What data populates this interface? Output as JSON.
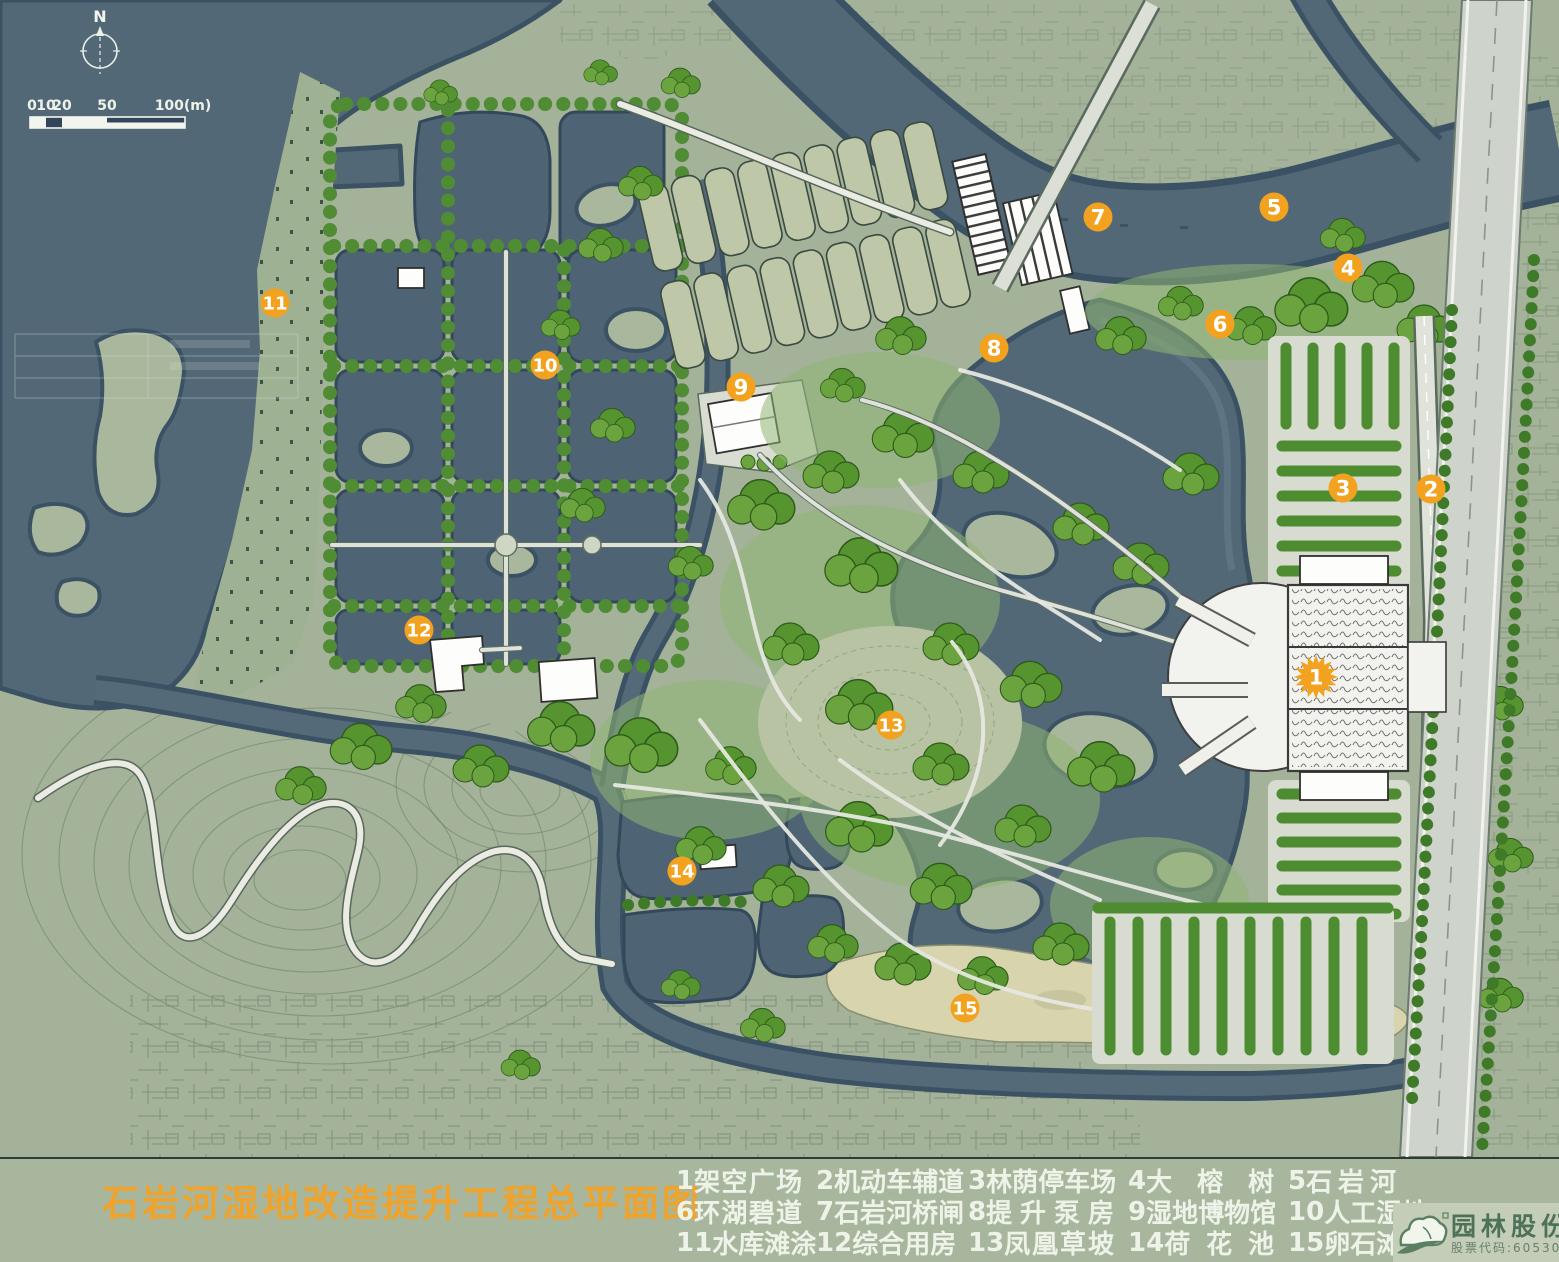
{
  "map": {
    "title": "石岩河湿地改造提升工程总平面图",
    "north_label": "N",
    "scale_bar": {
      "labels": [
        "0",
        "10",
        "20",
        "50",
        "100(m)"
      ],
      "unit": "m"
    },
    "legend_rows": [
      [
        {
          "num": "1",
          "name": "架空广场"
        },
        {
          "num": "2",
          "name": "机动车辅道"
        },
        {
          "num": "3",
          "name": "林荫停车场"
        },
        {
          "num": "4",
          "name": "大榕树"
        },
        {
          "num": "5",
          "name": "石岩河"
        }
      ],
      [
        {
          "num": "6",
          "name": "环湖碧道"
        },
        {
          "num": "7",
          "name": "石岩河桥闸"
        },
        {
          "num": "8",
          "name": "提升泵房"
        },
        {
          "num": "9",
          "name": "湿地博物馆"
        },
        {
          "num": "10",
          "name": "人工湿地"
        }
      ],
      [
        {
          "num": "11",
          "name": "水库滩涂"
        },
        {
          "num": "12",
          "name": "综合用房"
        },
        {
          "num": "13",
          "name": "凤凰草坡"
        },
        {
          "num": "14",
          "name": "荷花池"
        },
        {
          "num": "15",
          "name": "卵石滩"
        }
      ]
    ],
    "markers": [
      {
        "num": "1",
        "x": 1316,
        "y": 677,
        "starburst": true
      },
      {
        "num": "2",
        "x": 1431,
        "y": 489
      },
      {
        "num": "3",
        "x": 1343,
        "y": 488
      },
      {
        "num": "4",
        "x": 1348,
        "y": 268
      },
      {
        "num": "5",
        "x": 1274,
        "y": 207
      },
      {
        "num": "6",
        "x": 1220,
        "y": 324
      },
      {
        "num": "7",
        "x": 1098,
        "y": 217
      },
      {
        "num": "8",
        "x": 994,
        "y": 348
      },
      {
        "num": "9",
        "x": 741,
        "y": 387
      },
      {
        "num": "10",
        "x": 545,
        "y": 365
      },
      {
        "num": "11",
        "x": 275,
        "y": 303
      },
      {
        "num": "12",
        "x": 419,
        "y": 630
      },
      {
        "num": "13",
        "x": 891,
        "y": 725
      },
      {
        "num": "14",
        "x": 682,
        "y": 871
      },
      {
        "num": "15",
        "x": 965,
        "y": 1008
      }
    ],
    "logo": {
      "company": "园林股份",
      "stock_label": "股票代码:605303",
      "registered_mark": "®"
    },
    "colors": {
      "water": "#536877",
      "water_edge": "#3b5264",
      "land": "#a3b299",
      "tree_green": "#55942f",
      "road": "#eaece4",
      "highway": "#ced3cc",
      "treatment_cell": "#bec8a9",
      "pebble_beach": "#d8d4ad",
      "marker_orange": "#f2a21f",
      "title_orange": "#f0a32a",
      "legend_text": "#eef3e9",
      "logo_green": "#4e7258"
    }
  }
}
